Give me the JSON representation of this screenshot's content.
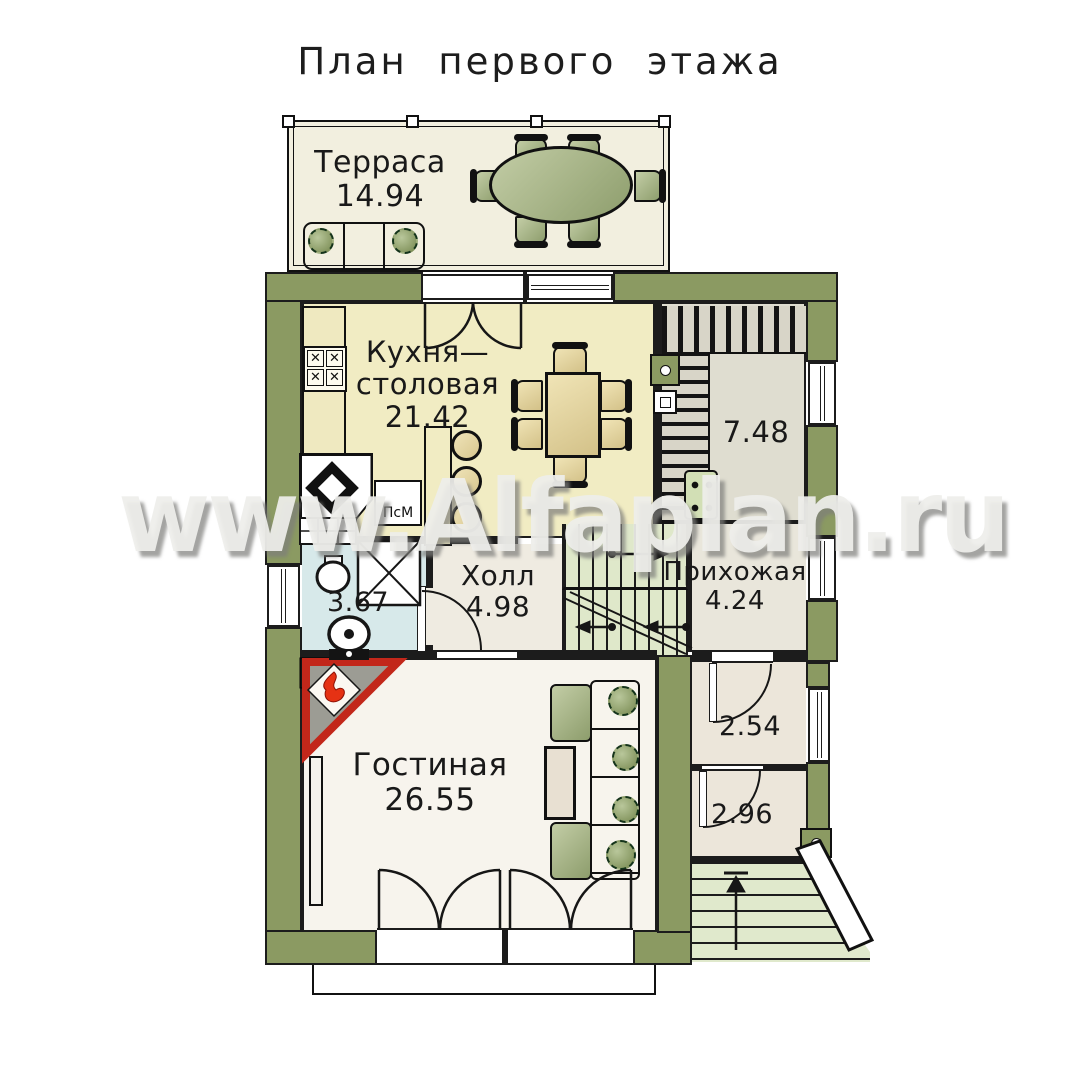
{
  "title": "План первого этажа",
  "watermark": "www.Alfaplan.ru",
  "rooms": {
    "terrace": {
      "name": "Терраса",
      "area": "14.94"
    },
    "kitchen": {
      "line1": "Кухня—",
      "line2": "столовая",
      "area": "21.42"
    },
    "wardrobe": {
      "area": "7.48"
    },
    "hall": {
      "name": "Холл",
      "area": "4.98"
    },
    "entry": {
      "name": "Прихожая",
      "area": "4.24"
    },
    "bathroom": {
      "area": "3.67"
    },
    "living": {
      "name": "Гостиная",
      "area": "26.55"
    },
    "closet": {
      "area": "2.54"
    },
    "tambour": {
      "area": "2.96"
    }
  },
  "appliances": {
    "dishwasher": "ПсМ"
  },
  "colors": {
    "wall": "#8b9a62",
    "kitchen_floor": "#f1ecc3",
    "living_floor": "#f7f4ed",
    "bath_floor": "#d7e9ea",
    "hall_floor": "#efebe1",
    "stairs_green": "#dfe8ca",
    "fireplace_red": "#c2271a",
    "furniture_green": "#a3b280"
  }
}
